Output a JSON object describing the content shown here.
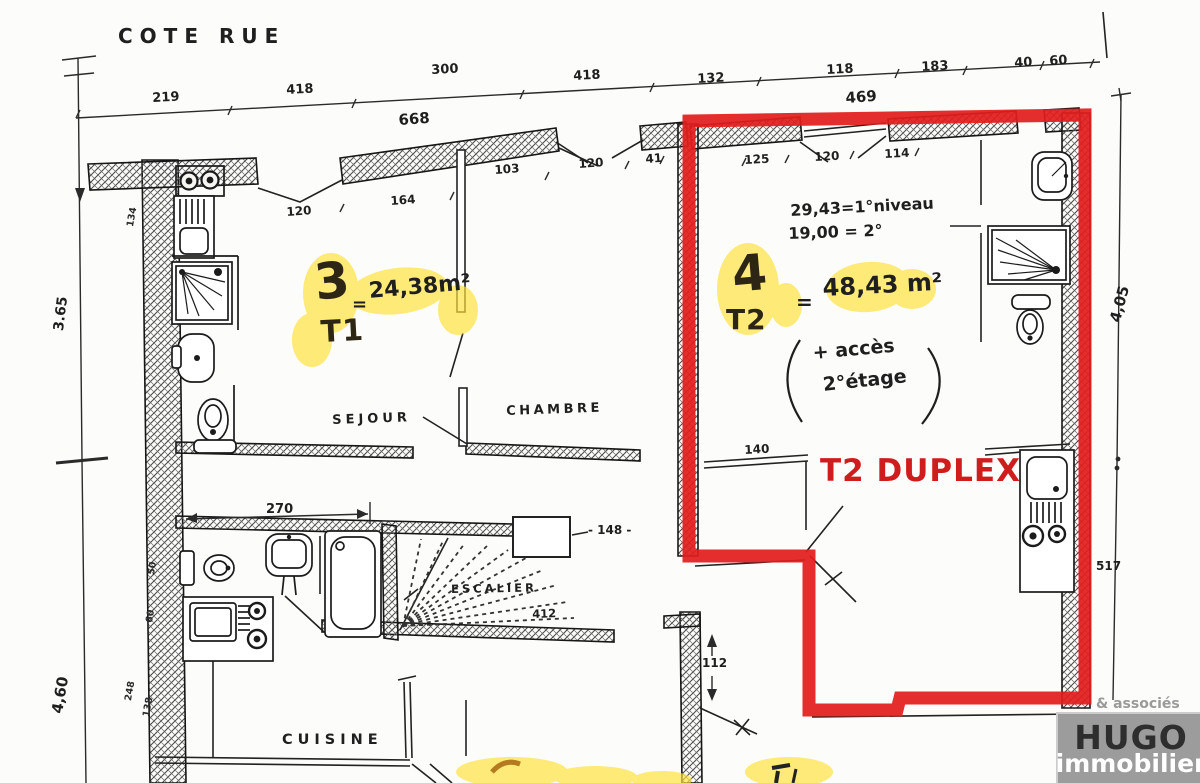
{
  "plan": {
    "street_label": "COTE RUE",
    "apartment3": {
      "number": "3",
      "equals": "=",
      "area": "24,38m²",
      "type": "T1"
    },
    "apartment4": {
      "number": "4",
      "equals": "=",
      "area": "48,43 m²",
      "type": "T2",
      "note_line1": "29,43=1°niveau",
      "note_line2": "19,00 = 2°",
      "access_line1": "+ accès",
      "access_line2": "2°étage",
      "duplex_label": "T2 DUPLEX"
    },
    "rooms": {
      "sejour": "SEJOUR",
      "chambre": "CHAMBRE",
      "escalier": "ESCALIER",
      "cuisine": "CUISINE"
    },
    "dims": {
      "top": [
        "219",
        "418",
        "300",
        "418",
        "132",
        "118",
        "183",
        "40",
        "60"
      ],
      "width_left": "668",
      "width_right": "469",
      "apt3_row": [
        "120",
        "164",
        "103",
        "120",
        "41"
      ],
      "apt4_row": [
        "125",
        "120",
        "114"
      ],
      "left_v1": "3.65",
      "left_v2": "4,60",
      "left_small": [
        "134",
        "50",
        "60",
        "248",
        "138"
      ],
      "right_v1": "4,05",
      "right_v2": "517",
      "sejour_w": "270",
      "stairs_w": "412",
      "landing_w": "- 148 -",
      "shelf_w": "140",
      "door_h": "112"
    },
    "logo": {
      "associates": "& associés",
      "name": "HUGO",
      "tagline": "immobilier"
    },
    "colors": {
      "outline_red": "#e21d1d",
      "duplex_text_red": "#cf1d1d",
      "highlight_yellow": "#ffe23a",
      "ink": "#1f1f1f",
      "logo_gray": "#9c9c9c"
    }
  }
}
